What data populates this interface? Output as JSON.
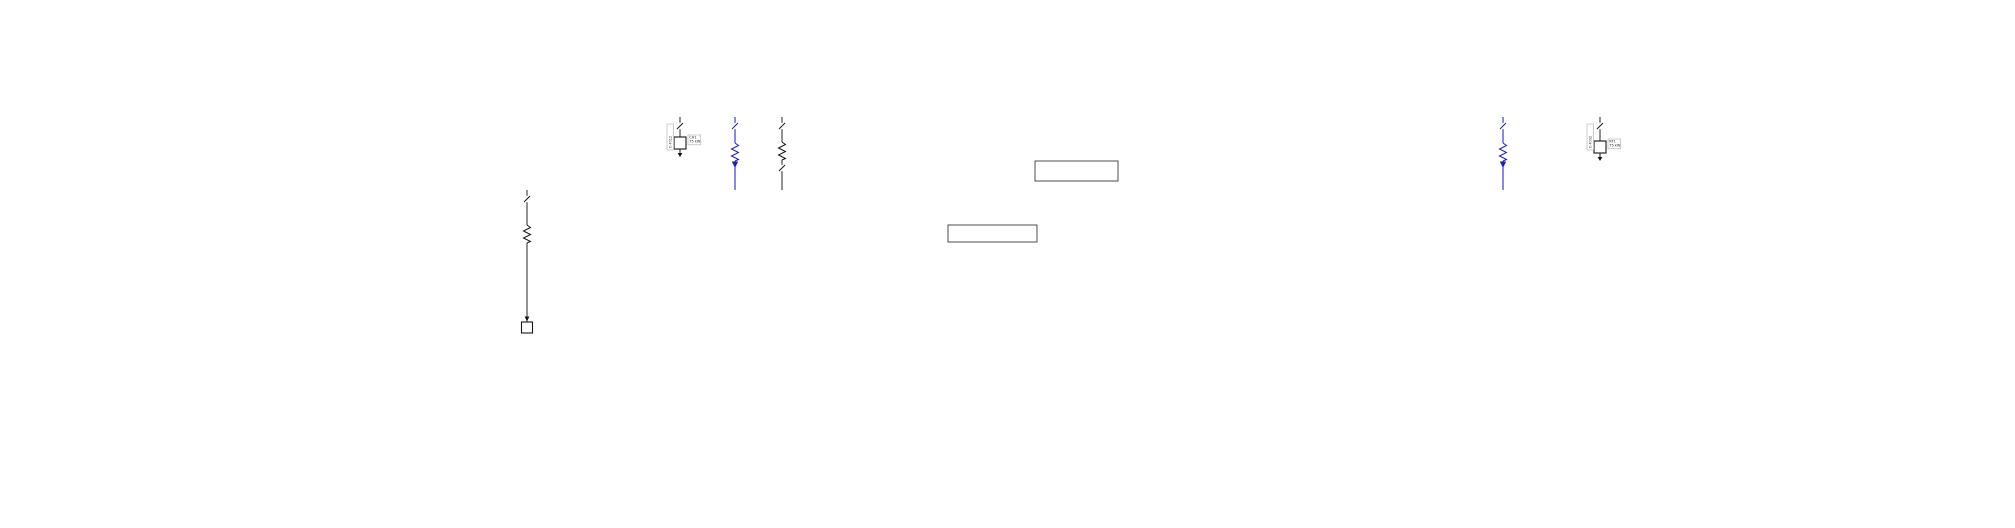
{
  "colors": {
    "blue": "#1b1bd0",
    "black": "#161616",
    "line_black": "#2e2e2e",
    "box_border": "#ababab",
    "text": "#1a1a1a"
  },
  "canvas": {
    "w": 2015,
    "h": 528
  },
  "buses": [
    {
      "id": "bus1",
      "x1": 778,
      "x2": 1648,
      "y": 117,
      "c": "k"
    },
    {
      "id": "genbus",
      "x1": 660,
      "x2": 743,
      "y": 117,
      "c": "b"
    },
    {
      "id": "bus2",
      "x1": 512,
      "x2": 1383,
      "y": 190,
      "c": "k"
    },
    {
      "id": "bus3",
      "x1": 1427,
      "x2": 1797,
      "y": 190,
      "c": "b"
    },
    {
      "id": "bus4",
      "x1": 58,
      "x2": 597,
      "y": 222,
      "c": "b"
    },
    {
      "id": "bus5",
      "x1": 33,
      "x2": 243,
      "y": 350,
      "c": "b"
    },
    {
      "id": "bus6",
      "x1": 1760,
      "x2": 1957,
      "y": 320,
      "c": "b"
    },
    {
      "id": "bus7",
      "x1": 1305,
      "x2": 1360,
      "y": 223,
      "c": "k"
    }
  ],
  "rects": [
    {
      "id": "net-eq-box",
      "x": 1035,
      "y": 161,
      "w": 83,
      "h": 20,
      "c": "k"
    },
    {
      "id": "mcc-box",
      "x": 948,
      "y": 225,
      "w": 89,
      "h": 17,
      "c": "k"
    }
  ],
  "chains": [
    {
      "id": "utility-incomer",
      "x": 866,
      "top": 8,
      "bus": "bus1",
      "c": "k",
      "items": [
        {
          "t": "tri",
          "y": 14
        },
        {
          "t": "node",
          "y": 32
        },
        {
          "t": "brk",
          "y": 46
        },
        {
          "t": "x2",
          "y": 62
        },
        {
          "t": "coil",
          "y": 79
        },
        {
          "t": "brk",
          "y": 93
        },
        {
          "t": "brk",
          "y": 105
        }
      ],
      "vbox": {
        "x": 846,
        "y": 26,
        "h": 30,
        "txt": "CB-M1"
      }
    },
    {
      "id": "generator-branch",
      "x": 715,
      "top": 41,
      "bus": "genbus",
      "c": "b",
      "items": [
        {
          "t": "gen",
          "y": 48
        },
        {
          "t": "coil",
          "y": 66
        },
        {
          "t": "brk",
          "y": 90
        }
      ],
      "vbox": {
        "x": 700,
        "y": 56,
        "h": 26,
        "txt": "G-1"
      }
    }
  ],
  "branches": [
    {
      "bus": "bus1",
      "x": 782,
      "c": "k",
      "tag": "TA1",
      "chain": true,
      "coil": 151,
      "brk2": 168,
      "end": "line",
      "ey": 190
    },
    {
      "bus": "bus1",
      "x": 1503,
      "c": "b",
      "tag": "TB1",
      "chain": true,
      "coil": 152,
      "arrow2": 168,
      "end": "line",
      "ey": 190
    },
    {
      "bus": "genbus",
      "x": 735,
      "c": "b",
      "tag": "TG1",
      "chain": true,
      "coil": 152,
      "arrow2": 168,
      "end": "line",
      "ey": 190
    },
    {
      "bus": "bus1",
      "x": 1600,
      "c": "k",
      "tag": "F002",
      "ld": "RT1",
      "end": "box",
      "ey": 141
    },
    {
      "bus": "genbus",
      "x": 680,
      "c": "k",
      "tag": "F012",
      "ld": "CH1",
      "end": "box",
      "ey": 137
    },
    {
      "bus": "bus2",
      "x": 527,
      "c": "k",
      "tag": "F101",
      "ld": "LD101",
      "coil": 234,
      "end": "sq",
      "ey": 322
    },
    {
      "bus": "bus2",
      "x": 568,
      "c": "b",
      "tag": "L101",
      "end": "arrow",
      "ey": 222
    },
    {
      "bus": "bus2",
      "x": 615,
      "c": "k",
      "tag": "F102",
      "ld": "LD102",
      "coil": 234,
      "end": "sq",
      "ey": 326
    },
    {
      "bus": "bus2",
      "x": 663,
      "c": "k",
      "tag": "F103",
      "ld": "LD103",
      "coil": 234,
      "end": "sq",
      "ey": 326
    },
    {
      "bus": "bus2",
      "x": 711,
      "c": "k",
      "tag": "F104",
      "ld": "LD104",
      "coil": 234,
      "end": "sq",
      "ey": 326
    },
    {
      "bus": "bus2",
      "x": 758,
      "c": "k",
      "tag": "F105",
      "ld": "LD105",
      "coil": 234,
      "end": "sq",
      "ey": 418
    },
    {
      "bus": "bus2",
      "x": 806,
      "c": "k",
      "tag": "F106",
      "ld": "LD106",
      "coil": 234,
      "end": "sq",
      "ey": 418
    },
    {
      "bus": "bus2",
      "x": 855,
      "c": "k",
      "tag": "F107",
      "ld": "LD107",
      "coil": 238,
      "end": "sq",
      "ey": 249
    },
    {
      "bus": "bus2",
      "x": 903,
      "c": "k",
      "tag": "F108",
      "ld": "LD108",
      "coil": 238,
      "end": "sq",
      "ey": 249
    },
    {
      "bus": "bus2",
      "x": 950,
      "c": "k",
      "tag": "F109",
      "end": "line",
      "ey": 225
    },
    {
      "bus": "bus2",
      "x": 998,
      "c": "k",
      "tag": "F110",
      "end": "line",
      "ey": 225
    },
    {
      "bus": "bus2",
      "x": 1070,
      "c": "b",
      "tag": "F111",
      "ld": "LD111",
      "coil": 265,
      "end": "sq",
      "ey": 337
    },
    {
      "bus": "bus2",
      "x": 1093,
      "c": "k",
      "tag": "F112",
      "ld": "LD112",
      "coil": 238,
      "end": "sq",
      "ey": 249
    },
    {
      "bus": "bus2",
      "x": 1141,
      "c": "k",
      "tag": "F113",
      "ld": "LD113",
      "coil": 238,
      "end": "sq",
      "ey": 249
    },
    {
      "bus": "bus2",
      "x": 1192,
      "c": "k",
      "tag": "F114",
      "ld": "LD114",
      "coil": 236,
      "end": "sq",
      "ey": 388
    },
    {
      "bus": "bus2",
      "x": 1238,
      "c": "k",
      "tag": "F115",
      "ld": "LD115",
      "coil": 236,
      "end": "sq",
      "ey": 388
    },
    {
      "bus": "bus2",
      "x": 1287,
      "c": "k",
      "tag": "F116",
      "ld": "LD116",
      "coil": 238,
      "end": "sq",
      "ey": 249
    },
    {
      "bus": "bus2",
      "x": 1333,
      "c": "k",
      "tag": "L102",
      "end": "arrow",
      "ey": 223
    },
    {
      "bus": "bus4",
      "x": 110,
      "c": "b",
      "tag": "F201",
      "ld": "LD201",
      "coil": 259,
      "end": "sq",
      "ey": 277
    },
    {
      "bus": "bus4",
      "x": 158,
      "c": "b",
      "tag": "L201",
      "end": "arrow",
      "ey": 350
    },
    {
      "bus": "bus4",
      "x": 205,
      "c": "b",
      "tag": "F202",
      "ld": "LD202",
      "coil": 259,
      "end": "sq",
      "ey": 277
    },
    {
      "bus": "bus4",
      "x": 253,
      "c": "b",
      "tag": "F203",
      "ld": "LD203",
      "coil": 259,
      "end": "sq",
      "ey": 277
    },
    {
      "bus": "bus4",
      "x": 300,
      "c": "b",
      "tag": "F204",
      "ld": "LD204",
      "coil": 259,
      "end": "sq",
      "ey": 277
    },
    {
      "bus": "bus4",
      "x": 352,
      "c": "b",
      "tag": "F205",
      "ld": "LD205",
      "coil": 259,
      "end": "sq",
      "ey": 411
    },
    {
      "bus": "bus4",
      "x": 400,
      "c": "b",
      "tag": "F206",
      "ld": "LD206",
      "coil": 259,
      "end": "sq",
      "ey": 411
    },
    {
      "bus": "bus4",
      "x": 448,
      "c": "b",
      "tag": "F207",
      "ld": "LD207",
      "coil": 259,
      "end": "sq",
      "ey": 502
    },
    {
      "bus": "bus4",
      "x": 495,
      "c": "b",
      "tag": "F208",
      "ld": "LD208",
      "coil": 259,
      "end": "sq",
      "ey": 277
    },
    {
      "bus": "bus4",
      "x": 543,
      "c": "b",
      "tag": "F209",
      "ld": "LD209",
      "coil": 259,
      "end": "sq",
      "ey": 277
    },
    {
      "bus": "bus5",
      "x": 38,
      "c": "b",
      "tag": "F301",
      "ld": "LD301",
      "coil": 387,
      "end": "sq",
      "ey": 404
    },
    {
      "bus": "bus5",
      "x": 87,
      "c": "b",
      "tag": "F302",
      "ld": "LD302",
      "coil": 387,
      "end": "sq",
      "ey": 404
    },
    {
      "bus": "bus5",
      "x": 135,
      "c": "b",
      "tag": "F303",
      "ld": "LD303",
      "coil": 387,
      "end": "sq",
      "ey": 404
    },
    {
      "bus": "bus5",
      "x": 183,
      "c": "b",
      "tag": "F304",
      "ld": "LD304",
      "coil": 387,
      "end": "sq",
      "ey": 404
    },
    {
      "bus": "bus5",
      "x": 232,
      "c": "b",
      "tag": "F305",
      "ld": "LD305",
      "end": "box",
      "ey": 374
    },
    {
      "bus": "bus3",
      "x": 1433,
      "c": "b",
      "tag": "F401",
      "ld": "LD401",
      "end": "box",
      "ey": 216
    },
    {
      "bus": "bus3",
      "x": 1527,
      "c": "b",
      "tag": "F402",
      "ld": "LD402",
      "coil": 249,
      "end": "sq",
      "ey": 283
    },
    {
      "bus": "bus3",
      "x": 1573,
      "c": "b",
      "tag": "F403",
      "ld": "LD403",
      "coil": 249,
      "end": "sq",
      "ey": 283
    },
    {
      "bus": "bus3",
      "x": 1625,
      "c": "b",
      "tag": "F404",
      "ld": "LD404",
      "coil": 249,
      "end": "sq",
      "ey": 298
    },
    {
      "bus": "bus3",
      "x": 1672,
      "c": "b",
      "tag": "F405",
      "ld": "LD405",
      "coil": 249,
      "end": "sq",
      "ey": 298
    },
    {
      "bus": "bus3",
      "x": 1720,
      "c": "b",
      "tag": "F406",
      "ld": "LD406",
      "coil": 242,
      "end": "sq",
      "ey": 399
    },
    {
      "bus": "bus6",
      "x": 1765,
      "c": "b",
      "tag": "F501",
      "ld": "LD501",
      "coil": 357,
      "end": "sq",
      "ey": 374
    },
    {
      "bus": "bus6",
      "x": 1810,
      "c": "b",
      "tag": "F502",
      "ld": "LD502",
      "coil": 357,
      "end": "sq",
      "ey": 374
    },
    {
      "bus": "bus6",
      "x": 1858,
      "c": "b",
      "tag": "F503",
      "ld": "LD503",
      "coil": 357,
      "end": "sq",
      "ey": 374
    },
    {
      "bus": "bus6",
      "x": 1907,
      "c": "b",
      "tag": "F504",
      "ld": "LD504",
      "coil": 357,
      "end": "sq",
      "ey": 374
    },
    {
      "bus": "bus6",
      "x": 1955,
      "c": "b",
      "tag": "F505",
      "ld": "LD505",
      "end": "box",
      "ey": 343
    },
    {
      "bus": "bus7",
      "x": 1358,
      "c": "k",
      "tag": "F601",
      "ld": "LD601",
      "coil": 266,
      "end": "sq",
      "ey": 388
    }
  ],
  "links": [
    {
      "id": "tie-bus3-bus6",
      "c": "b",
      "pts": [
        [
          1767,
          190
        ],
        [
          1767,
          255
        ],
        [
          1789,
          255
        ],
        [
          1789,
          313
        ]
      ],
      "brk": [
        1767,
        197
      ],
      "arrow": [
        1789,
        320
      ]
    },
    {
      "id": "stub-ld407",
      "c": "b",
      "pts": [
        [
          1789,
          255
        ],
        [
          1840,
          255
        ],
        [
          1840,
          262
        ]
      ],
      "coil": [
        1840,
        268
      ],
      "box": [
        1840,
        276
      ],
      "tag": "F407",
      "ld": "LD407"
    },
    {
      "id": "neteq-tie",
      "c": "k",
      "pts": [
        [
          1118,
          181
        ],
        [
          1118,
          190
        ]
      ],
      "brk": [
        1118,
        185
      ]
    }
  ],
  "annotations": [
    {
      "x": 879,
      "y": 6,
      "c": "k",
      "lines": [
        "NET-1",
        "115 kV",
        "Sk 3500 MVA"
      ]
    },
    {
      "x": 879,
      "y": 29,
      "c": "k",
      "lines": [
        "CB-M0"
      ]
    },
    {
      "x": 879,
      "y": 42,
      "c": "k",
      "lines": [
        "DS-M0",
        "1250 A"
      ]
    },
    {
      "x": 881,
      "y": 55,
      "c": "k",
      "lines": [
        "TR-M0",
        "40 MVA",
        "115/6.3 kV"
      ]
    },
    {
      "x": 879,
      "y": 73,
      "c": "k",
      "lines": [
        "XR-M0",
        "x 6 %"
      ]
    },
    {
      "x": 879,
      "y": 92,
      "c": "k",
      "lines": [
        "CB-M1"
      ]
    },
    {
      "x": 725,
      "y": 38,
      "c": "b",
      "lines": [
        "GEN-1",
        "6.3 kV",
        "5.2 MW"
      ]
    },
    {
      "x": 725,
      "y": 80,
      "c": "b",
      "lines": [
        "XC-G1",
        "x 2.4 %"
      ]
    },
    {
      "x": 656,
      "y": 95,
      "c": "b",
      "lines": [
        "BUS-G1",
        "6.30 kV",
        "u 100 %",
        "-12.4 deg"
      ]
    },
    {
      "x": 737,
      "y": 88,
      "c": "k",
      "lines": [
        "P 4.8 MW",
        "Q 1.2 Mvar",
        "I 492 A",
        "cos 0.97"
      ]
    },
    {
      "x": 774,
      "y": 88,
      "c": "k",
      "lines": [
        "U 6.28 kV",
        "u 99.7 %",
        "-12.4 deg"
      ]
    },
    {
      "x": 790,
      "y": 119,
      "c": "k",
      "lines": [
        "CB-A1",
        "In 630 A",
        "Ik 18 kA"
      ]
    },
    {
      "x": 790,
      "y": 145,
      "c": "k",
      "lines": [
        "TR-A1",
        "6.3 MVA"
      ]
    },
    {
      "x": 790,
      "y": 163,
      "c": "k",
      "lines": [
        "CB-A2",
        "In 630 A"
      ]
    },
    {
      "x": 742,
      "y": 119,
      "c": "b",
      "lines": [
        "CB-G2",
        "In 630 A",
        "Ik 18 kA"
      ]
    },
    {
      "x": 742,
      "y": 146,
      "c": "b",
      "lines": [
        "TR-G2",
        "6.3 MVA"
      ]
    },
    {
      "x": 742,
      "y": 164,
      "c": "b",
      "lines": [
        "FD-G2",
        "u 98 %"
      ]
    },
    {
      "x": 1510,
      "y": 119,
      "c": "b",
      "lines": [
        "CB-B1",
        "In 630 A",
        "Ik 18 kA"
      ]
    },
    {
      "x": 1510,
      "y": 146,
      "c": "b",
      "lines": [
        "TR-B1",
        "2.5 MVA"
      ]
    },
    {
      "x": 1510,
      "y": 164,
      "c": "b",
      "lines": [
        "FD-B1",
        "u 97 %"
      ]
    },
    {
      "x": 1610,
      "y": 139,
      "c": "k",
      "lines": [
        "RT-1",
        "260 kW"
      ]
    },
    {
      "x": 692,
      "y": 139,
      "c": "k",
      "lines": [
        "CH-1",
        "110 kW"
      ]
    },
    {
      "x": 574,
      "y": 195,
      "c": "k",
      "lines": [
        "BUS-C1",
        "0.40 kV",
        "u 97.8 %",
        "Ik 28 kA"
      ]
    },
    {
      "x": 164,
      "y": 321,
      "c": "b",
      "lines": [
        "FD-C5",
        "In 400 A"
      ]
    },
    {
      "x": 1795,
      "y": 299,
      "c": "b",
      "lines": [
        "FD-D5",
        "In 400 A"
      ]
    },
    {
      "x": 1610,
      "y": 96,
      "c": "k",
      "lines": [
        "BUS-M1",
        "6.30 kV",
        "u 99.2 %"
      ]
    },
    {
      "x": 1387,
      "y": 175,
      "c": "k",
      "lines": [
        "BUS-A1",
        "6.30 kV",
        "u 98.9 %"
      ]
    },
    {
      "x": 1387,
      "y": 204,
      "c": "k",
      "lines": [
        "Ik 18.9 kA",
        "ip 48.2 kA",
        "Sk 206 MVA"
      ]
    },
    {
      "x": 1367,
      "y": 207,
      "c": "k",
      "lines": [
        "BUS-A2",
        "6.30 kV",
        "u 98.8 %",
        "Ik 18 kA"
      ]
    },
    {
      "x": 1366,
      "y": 227,
      "c": "k",
      "lines": [
        "ip 46 kA",
        "Sk 201 MVA",
        "Ith 19 kA"
      ]
    },
    {
      "x": 1822,
      "y": 169,
      "c": "b",
      "lines": [
        "BUS-B1",
        "0.40 kV",
        "u 97.1 %",
        "Ik 32 kA"
      ]
    },
    {
      "x": 603,
      "y": 206,
      "c": "b",
      "lines": [
        "BUS-C2",
        "0.40 kV",
        "u 97.6 %",
        "Ik 27 kA"
      ]
    },
    {
      "x": 28,
      "y": 330,
      "c": "b",
      "lines": [
        "BUS-C5",
        "0.40 kV"
      ]
    },
    {
      "x": 246,
      "y": 333,
      "c": "b",
      "lines": [
        "u 96.9 %",
        "Ik 25 kA",
        "ip 55 kA",
        "Sk 18 MVA"
      ]
    },
    {
      "x": 1741,
      "y": 296,
      "c": "b",
      "lines": [
        "BUS-D5",
        "0.40 kV",
        "u 96.8 %"
      ]
    },
    {
      "x": 1960,
      "y": 297,
      "c": "b",
      "lines": [
        "u 96.8 %",
        "Ik 24 kA",
        "ip 52 kA",
        "Sk 17 MVA"
      ]
    },
    {
      "x": 1054,
      "y": 170,
      "c": "k",
      "lines": [
        "NET-EQ1",
        "6.3 kV"
      ]
    },
    {
      "x": 953,
      "y": 228,
      "c": "k",
      "lines": [
        "MCC-A1",
        "0.4 kV"
      ]
    }
  ],
  "label_templates": {
    "brk": [
      "{tag}",
      "In 630 A",
      "Ik 25 kA"
    ],
    "coil": [
      "TR-{tag}",
      "630 kVA"
    ],
    "sq": [
      "{ld}",
      "0.4 kV",
      "160 kW",
      "cos 0.85"
    ],
    "box": [
      "{ld}",
      "75 kW"
    ],
    "vbox": "C-{tag}"
  }
}
